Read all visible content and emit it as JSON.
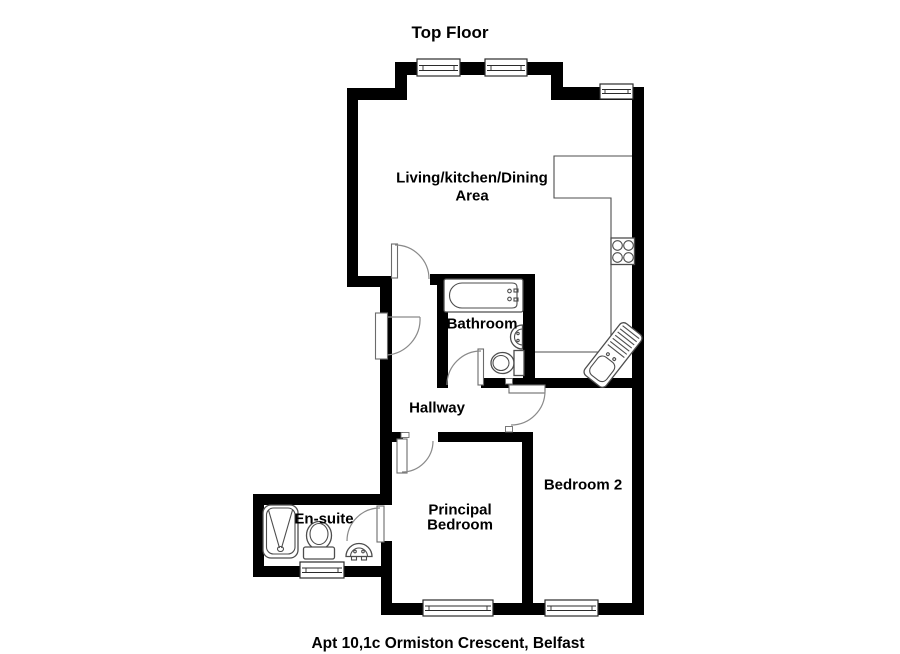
{
  "title": "Top Floor",
  "caption": "Apt 10,1c Ormiston Crescent, Belfast",
  "rooms": {
    "living": {
      "line1": "Living/kitchen/Dining",
      "line2": "Area"
    },
    "bathroom": {
      "label": "Bathroom"
    },
    "hallway": {
      "label": "Hallway"
    },
    "principal_bedroom": {
      "line1": "Principal",
      "line2": "Bedroom"
    },
    "bedroom2": {
      "label": "Bedroom 2"
    },
    "ensuite": {
      "label": "En-suite"
    }
  },
  "colors": {
    "wall": "#000000",
    "fixture_line": "#4d4d4d",
    "door_arc": "#8a8a8a",
    "background": "#ffffff",
    "text": "#000000"
  }
}
